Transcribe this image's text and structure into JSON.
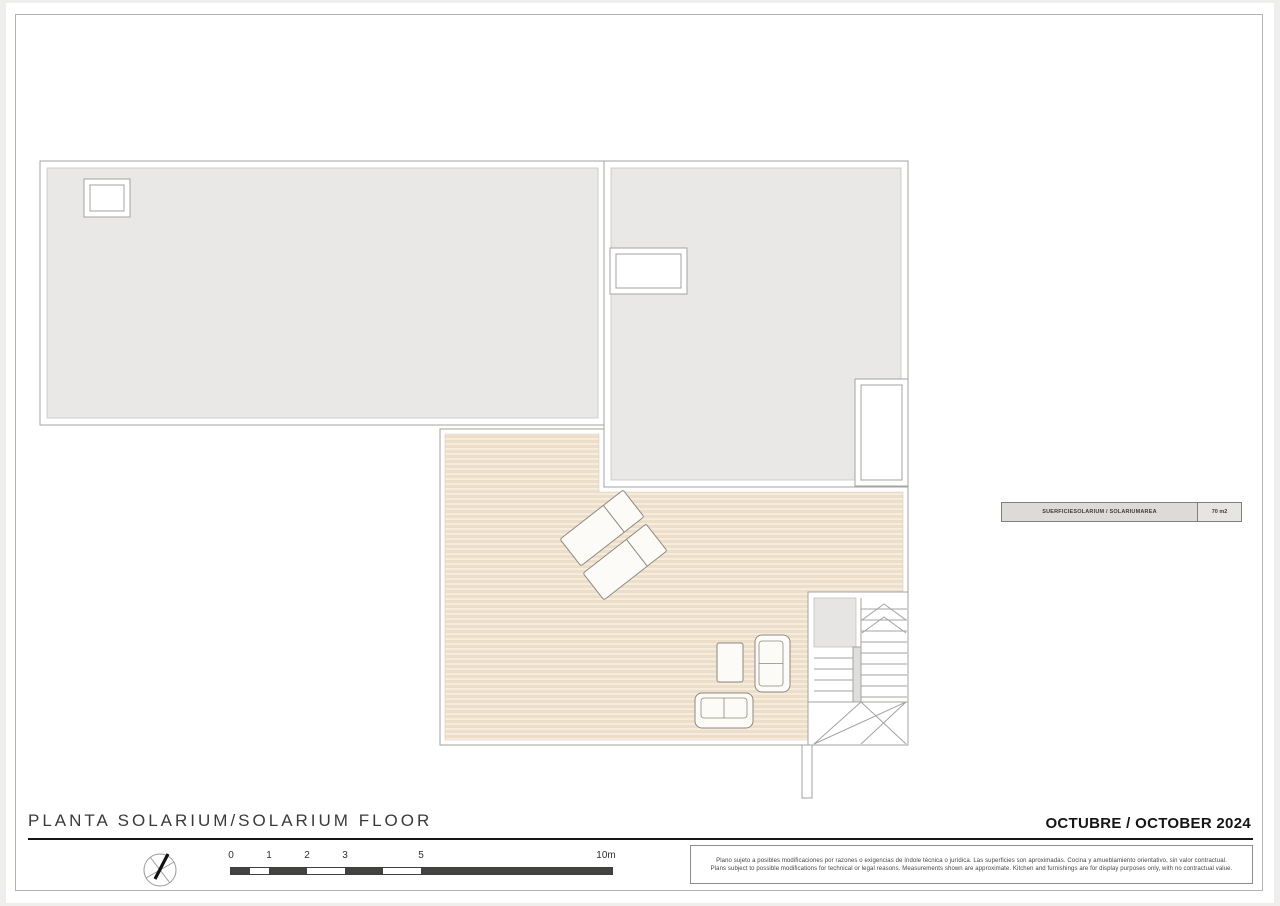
{
  "sheet": {
    "title": "PLANTA SOLARIUM/SOLARIUM FLOOR",
    "date": "OCTUBRE / OCTOBER 2024"
  },
  "area_table": {
    "label": "SUERFICIESOLARIUM / SOLARIUMAREA",
    "value": "70 m2"
  },
  "scale_bar": {
    "unit": "m",
    "ticks": [
      "0",
      "1",
      "2",
      "3",
      "5",
      "10m"
    ]
  },
  "disclaimer": {
    "lines": [
      "Plano sujeto a posibles modificaciones por razones o exigencias de índole técnica o jurídica. Las superficies son aproximadas. Cocina y amueblamiento orientativo, sin valor contractual.",
      "Plans subject to possible modifications for technical or legal reasons. Measurements shown are approximate. Kitchen and furnishings are for display purposes only, with no contractual value."
    ]
  },
  "icons": {
    "compass": "north-compass-icon"
  },
  "plan_features": [
    "roof-area-left",
    "roof-area-right",
    "roof-skylight-left",
    "roof-skylight-right",
    "roof-void",
    "solarium-deck",
    "staircase",
    "sun-lounger",
    "sofa",
    "coffee-table"
  ],
  "colors": {
    "roof_fill": "#e9e8e6",
    "deck_fill": "#eddec9",
    "deck_stripe": "#f6ecde",
    "stair_gray": "#e6e5e3",
    "outline": "#a3a3a1",
    "furniture_outline": "#8f897f",
    "divider": "#161616",
    "scale_dark": "#424240"
  }
}
